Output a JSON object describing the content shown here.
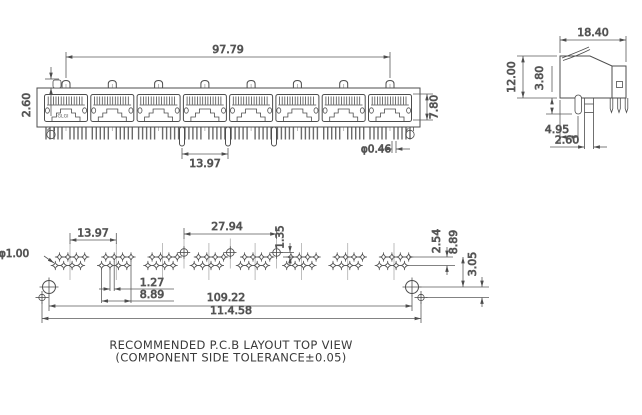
{
  "drawing": {
    "logo": "GLGI",
    "front": {
      "width": "97.79",
      "tab_height": "2.60",
      "port_height": "7.80",
      "post_pitch": "13.97",
      "pin_dia": "φ0.46"
    },
    "side": {
      "depth": "18.40",
      "height": "12.00",
      "post_depth": "3.80",
      "post_offset": "4.95",
      "leg_pitch": "2.60"
    },
    "pcb": {
      "hole_dia": "φ1.00",
      "group_pitch": "13.97",
      "post_span": "27.94",
      "post_offset": "1.35",
      "pin_pitch": "1.27",
      "group_span": "8.89",
      "row_pitch": "2.54",
      "hole_row_offset": "8.89",
      "small_hole_offset": "3.05",
      "mount_hole_span": "109.22",
      "small_hole_span": "11.4.58",
      "caption1": "RECOMMENDED P.C.B LAYOUT TOP VIEW",
      "caption2": "(COMPONENT SIDE TOLERANCE±0.05)"
    }
  }
}
